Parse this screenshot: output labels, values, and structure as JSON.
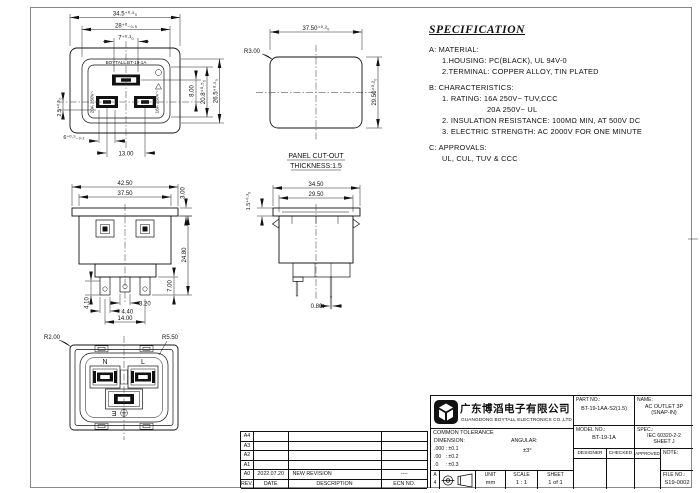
{
  "colors": {
    "ink": "#111111",
    "paper": "#ffffff"
  },
  "face_view": {
    "marking": "BOYTALL BT-19-1A",
    "rating_left": "20A 250V~",
    "rating_right": "16A 250V~",
    "dim_width_outer": "34.5⁺⁰·⁵₀",
    "dim_width_inner": "28⁺⁰₋₀.₅",
    "dim_slot_earth": "7⁺⁰·³₀",
    "dim_pin_offset": "8.00",
    "dim_height_slots": "20.8⁺⁰·⁵₀",
    "dim_height_inner": "26.5⁺⁰·⁵₀",
    "dim_edge": "2.5⁺⁰·⁵₀",
    "dim_slot_width": "6⁺⁰·⁵₋₀.₂",
    "dim_pin_pitch": "13.00"
  },
  "panel_cutout": {
    "radius": "R3.00",
    "dim_width": "37.50⁺⁰·²₀",
    "dim_height": "29.50⁺⁰·²₀",
    "label_line1": "PANEL CUT-OUT",
    "label_line2": "THICKNESS:1.5"
  },
  "front_view": {
    "dim_flange_width": "42.50",
    "dim_body_width": "37.50",
    "dim_flange_thk": "3.00",
    "dim_height": "24.80",
    "dim_pin_len": "7.00",
    "dim_hole": "4.10",
    "dim_pin_w_mid": "3.20",
    "dim_pin_w": "4.40",
    "dim_pitch": "14.00"
  },
  "side_view": {
    "dim_flange_width": "34.50",
    "dim_body_width": "29.50",
    "dim_panel_thk": "1.5⁺⁰·³₀",
    "dim_pin_thk": "0.80t"
  },
  "rear_view": {
    "radius_outer": "R2.00",
    "radius_inner": "R5.50",
    "label_n": "N",
    "label_l": "L",
    "label_e": "E"
  },
  "spec": {
    "title": "SPECIFICATION",
    "lines": [
      "A: MATERIAL:",
      "1.HOUSING: PC(BLACK), UL 94V-0",
      "2.TERMINAL: COPPER ALLOY, TIN PLATED",
      "B: CHARACTERISTICS:",
      "1. RATING: 16A 250V~ TUV,CCC",
      "20A 250V~ UL",
      "2. INSULATION RESISTANCE: 100MΩ MIN, AT 500V DC",
      "3. ELECTRIC STRENGTH: AC 2000V FOR ONE MINUTE",
      "C: APPROVALS:",
      "UL, CUL, TUV & CCC"
    ]
  },
  "title_block": {
    "company_cn": "广东博滔电子有限公司",
    "company_en": "GUANGDONG BOYTALL ELECTRONICS CO.,LTD",
    "common_tolerance": "COMMON TOLERANCE",
    "dimension_label": "DIMENSION:",
    "angular_label": "ANGULAR:",
    "tol_000": ".000 : ±0.1",
    "tol_00": ".00   : ±0.2",
    "tol_0": ".0     : ±0.3",
    "angular_value": "±3°",
    "paper_letter": "A",
    "paper_number": "4",
    "unit_label": "UNIT",
    "unit_value": "mm",
    "scale_label": "SCALE",
    "scale_value": "1 : 1",
    "sheet_label": "SHEET",
    "sheet_value": "1 of 1",
    "part_no_label": "PART NO.:",
    "part_no": "BT-19-1AA-S2(1.5)",
    "name_label": "NAME:",
    "name_line1": "AC OUTLET 3P",
    "name_line2": "(SNAP-IN)",
    "model_no_label": "MODEL NO.:",
    "model_no": "BT-19-1A",
    "spec_label": "SPEC.:",
    "spec_value_line1": "IEC 60320-2-2",
    "spec_value_line2": "SHEET J",
    "designer_label": "DESIGNER",
    "checked_label": "CHECKED",
    "approved_label": "APPROVED",
    "note_label": "NOTE:",
    "file_no_label": "FILE NO.:",
    "file_no": "S19-0002"
  },
  "revision": {
    "headers": [
      "REV.",
      "DATE",
      "DESCRIPTION",
      "ECN NO."
    ],
    "rows": [
      {
        "rev": "A4",
        "date": "",
        "description": "",
        "ecn": ""
      },
      {
        "rev": "A3",
        "date": "",
        "description": "",
        "ecn": ""
      },
      {
        "rev": "A2",
        "date": "",
        "description": "",
        "ecn": ""
      },
      {
        "rev": "A1",
        "date": "",
        "description": "",
        "ecn": ""
      },
      {
        "rev": "A0",
        "date": "2022.07.20",
        "description": "NEW REVISION",
        "ecn": "----"
      }
    ]
  }
}
